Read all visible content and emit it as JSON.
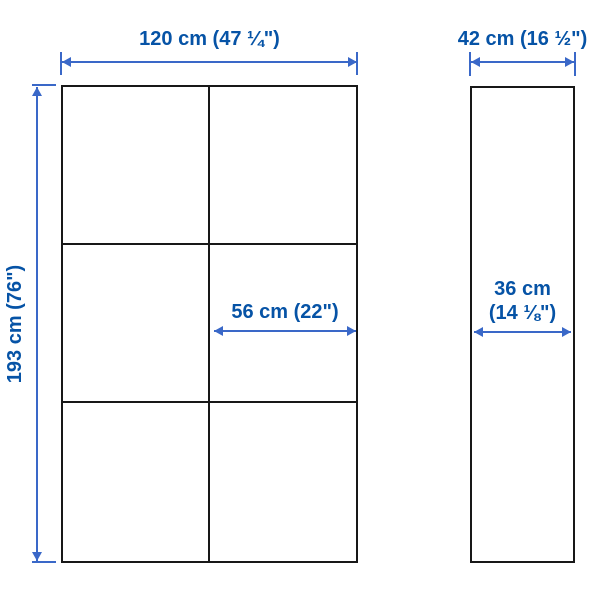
{
  "diagram": {
    "title": "product dimension diagram",
    "views": {
      "front": {
        "columns": 2,
        "rows": 3
      },
      "side": {}
    },
    "dimensions": {
      "front_width": "120 cm (47 ¼\")",
      "front_height": "193 cm (76\")",
      "door_width": "56 cm (22\")",
      "side_depth": "42 cm (16 ½\")",
      "inner_depth_line1": "36 cm",
      "inner_depth_line2": "(14 ⅛\")"
    },
    "colors": {
      "dimension_text_blue": "#0653a6",
      "dimension_line_blue": "#3a68c8",
      "cabinet_outline_black": "#181818",
      "background": "#ffffff"
    }
  }
}
